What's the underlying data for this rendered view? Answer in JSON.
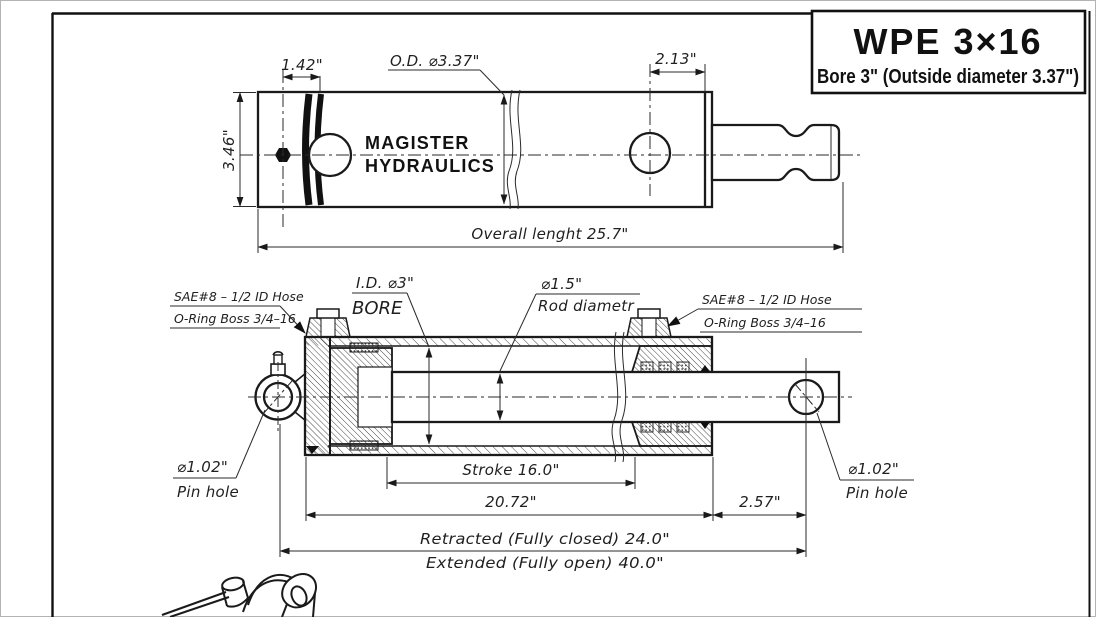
{
  "colors": {
    "ink": "#1a1a1a",
    "paper": "#ffffff",
    "frame": "#111111"
  },
  "title_block": {
    "model": "WPE 3×16",
    "subtitle": "Bore 3\" (Outside diameter 3.37\")"
  },
  "brand": {
    "line1": "MAGISTER",
    "line2": "HYDRAULICS"
  },
  "top_view": {
    "dim_gland": "1.42\"",
    "dim_od": "O.D. ⌀3.37\"",
    "dim_port": "2.13\"",
    "dim_height": "3.46\"",
    "dim_overall": "Overall lenght 25.7\""
  },
  "section_view": {
    "port_left": {
      "line1": "SAE#8 – 1/2 ID Hose",
      "line2": "O-Ring Boss 3/4–16"
    },
    "port_right": {
      "line1": "SAE#8 – 1/2 ID Hose",
      "line2": "O-Ring Boss 3/4–16"
    },
    "bore": {
      "line1": "I.D. ⌀3\"",
      "line2": "BORE"
    },
    "rod": {
      "line1": "⌀1.5\"",
      "line2": "Rod diametr"
    },
    "pin_left": {
      "line1": "⌀1.02\"",
      "line2": "Pin hole"
    },
    "pin_right": {
      "line1": "⌀1.02\"",
      "line2": "Pin hole"
    },
    "dim_stroke": "Stroke 16.0\"",
    "dim_body": "20.72\"",
    "dim_rod_end": "2.57\"",
    "dim_retracted": "Retracted (Fully closed) 24.0\"",
    "dim_extended": "Extended (Fully open) 40.0\""
  }
}
